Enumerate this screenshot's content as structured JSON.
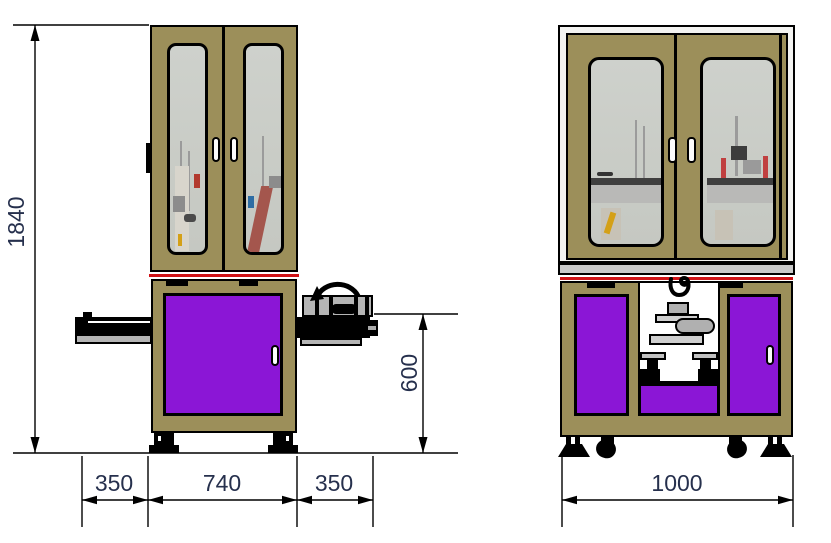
{
  "drawing": {
    "type": "machine-dimension-drawing",
    "views": {
      "front": "front-view",
      "side": "side-view"
    },
    "dimensions": {
      "overall_height": "1840",
      "front_left_extension": "350",
      "front_body_width": "740",
      "front_right_extension": "350",
      "work_height": "600",
      "side_body_width": "1000"
    },
    "colors": {
      "frame_khaki": "#9c8f5a",
      "panel_purple": "#8b16d6",
      "glass_gray": "#caccc6",
      "metal_gray": "#b5b5b5",
      "accent_red": "#d01317",
      "dimension_text": "#26304d",
      "outline": "#000000",
      "background": "#ffffff"
    },
    "icons": {
      "rotation_arrow": "arc-rotation-arrow",
      "hook": "crane-hook",
      "leveling_foot": "leveling-foot",
      "caster": "caster-wheel",
      "dimension_arrow": "dimension-arrowhead"
    }
  }
}
